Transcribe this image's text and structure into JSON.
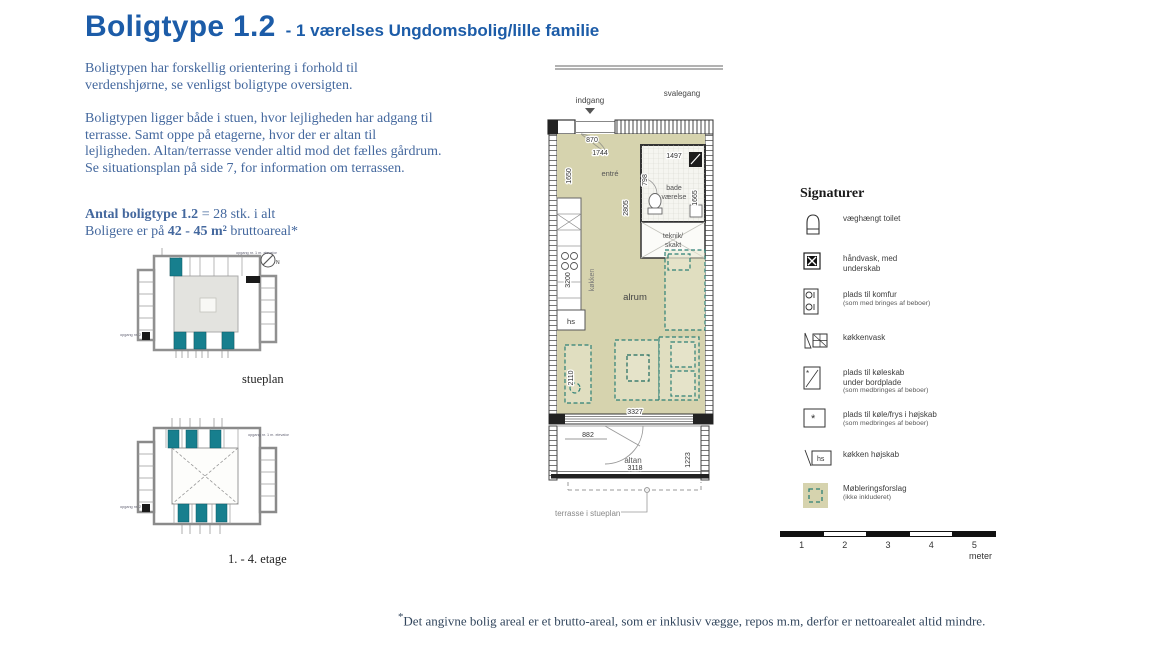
{
  "title": {
    "main": "Boligtype 1.2",
    "sub": "- 1 værelses Ungdomsbolig/lille familie"
  },
  "intro": {
    "para1": "Boligtypen har forskellig orientering i forhold til verdenshjørne, se venligst boligtype oversigten.",
    "para2": "Boligtypen ligger både i stuen, hvor lejligheden har adgang til terrasse. Samt oppe på etagerne, hvor der er altan til lejligheden. Altan/terrasse vender altid mod det fælles gårdrum. Se situationsplan på side 7, for information om terrassen."
  },
  "antal": {
    "bold": "Antal boligtype 1.2",
    "rest": " = 28 stk. i alt",
    "line2_pre": "Boligere er på ",
    "line2_bold": "42 - 45 m²",
    "line2_post": " bruttoareal*"
  },
  "site_plans": {
    "stueplan": {
      "label": "stueplan",
      "note_top": "opgang nr. 1 m. elevator",
      "note_left": "opgang nr. 2",
      "compass": "N"
    },
    "etage": {
      "label": "1. - 4. etage",
      "note_top": "opgang nr. 1 m. elevator",
      "note_left": "opgang nr. 2"
    }
  },
  "floor_plan": {
    "labels": {
      "indgang": "indgang",
      "svalegang": "svalegang",
      "entre": "entré",
      "bad1": "bade",
      "bad2": "værelse",
      "teknik1": "teknik/",
      "teknik2": "skakt",
      "kokken": "køkken",
      "hs": "hs",
      "alrum": "alrum",
      "altan": "altan",
      "terrasse_note": "terrasse i stueplan"
    },
    "dims": {
      "d870": "870",
      "d1744": "1744",
      "d1650": "1650",
      "d2805": "2805",
      "d1497": "1497",
      "d798": "798",
      "d1665": "1665",
      "d3200": "3200",
      "d2110": "2110",
      "d3327": "3327",
      "d882": "882",
      "d3118": "3118",
      "d1223": "1223"
    }
  },
  "legend": {
    "heading": "Signaturer",
    "items": [
      {
        "lines": [
          "væghængt toilet"
        ]
      },
      {
        "lines": [
          "håndvask, med",
          "underskab"
        ]
      },
      {
        "lines": [
          "plads til komfur",
          "(som med bringes af beboer)"
        ]
      },
      {
        "lines": [
          "køkkenvask"
        ]
      },
      {
        "lines": [
          "plads til køleskab",
          "under bordplade",
          "(som medbringes af beboer)"
        ]
      },
      {
        "lines": [
          "plads til køle/frys i højskab",
          "(som medbringes af beboer)"
        ]
      },
      {
        "lines": [
          "køkken højskab"
        ]
      },
      {
        "lines": [
          "Møbleringsforslag",
          "(ikke inkluderet)"
        ]
      }
    ],
    "hs_icon_text": "hs"
  },
  "scale_bar": {
    "ticks": [
      "1",
      "2",
      "3",
      "4",
      "5"
    ],
    "unit": "meter"
  },
  "footnote": {
    "star": "*",
    "text": "Det angivne bolig areal er et brutto-areal, som er inklusiv vægge, repos m.m, derfor er nettoarealet altid mindre."
  },
  "colors": {
    "title_blue": "#1c5ca8",
    "body_blue": "#44689e",
    "unit_teal": "#177f8e",
    "floor_khaki": "#d6d3ae",
    "furniture_teal": "#2e8076"
  }
}
